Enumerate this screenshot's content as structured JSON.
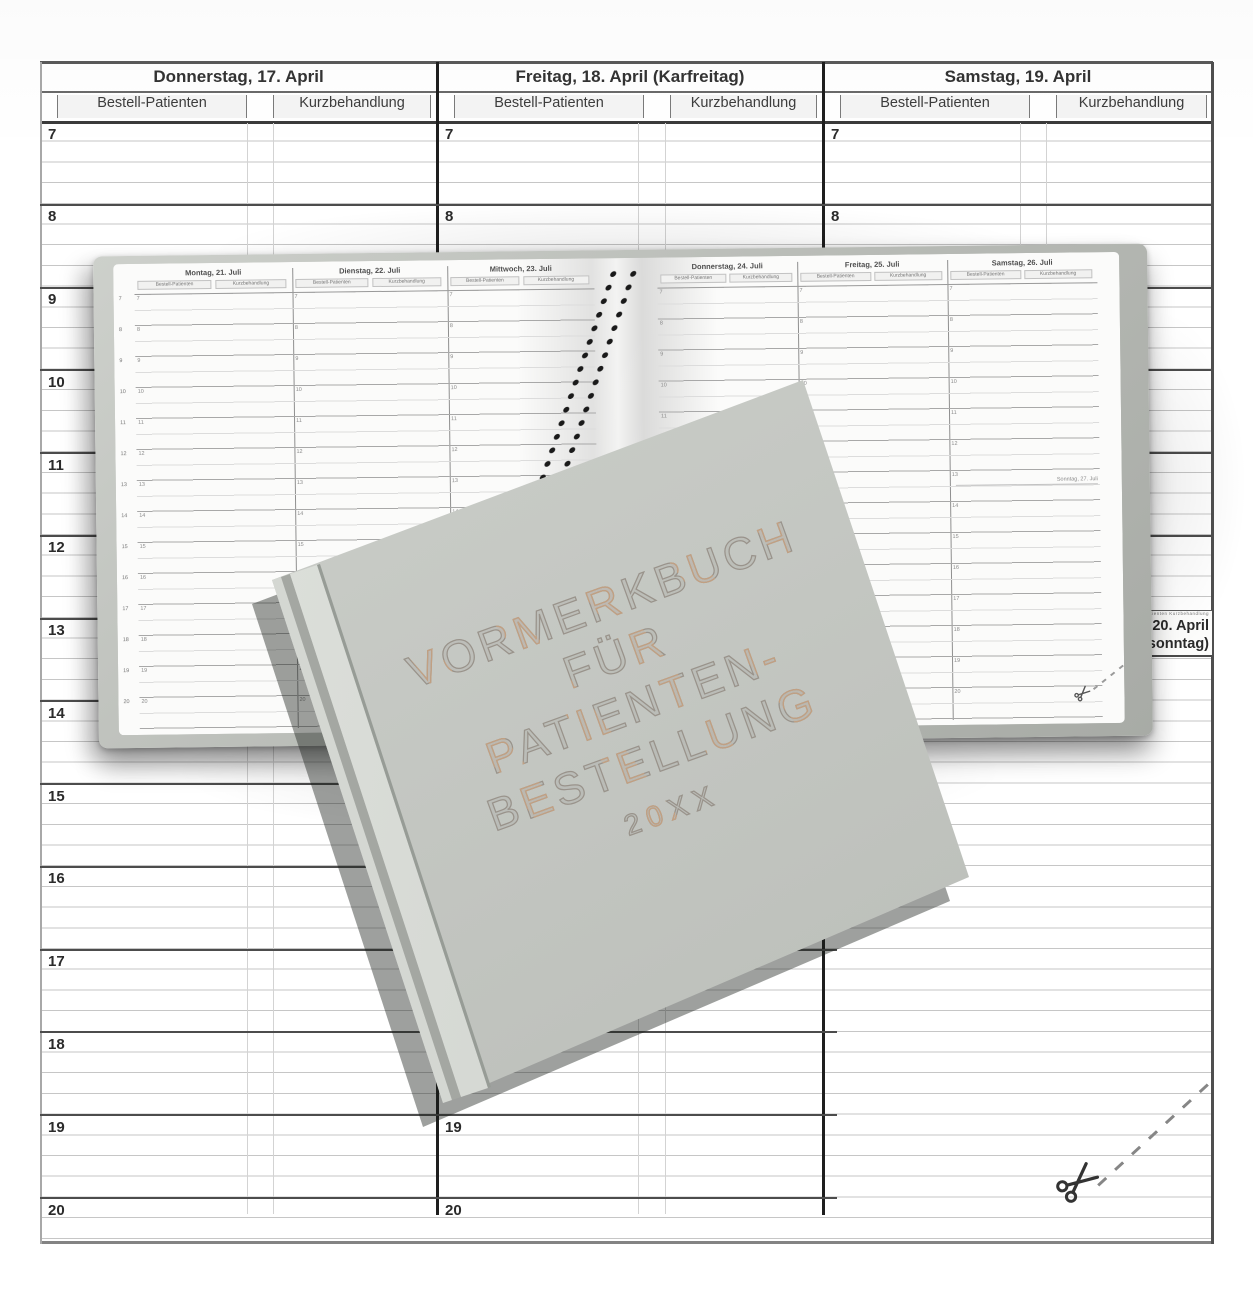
{
  "calendar": {
    "days": [
      {
        "title": "Donnerstag, 17. April",
        "sub_left": "Bestell-Patienten",
        "sub_right": "Kurzbehandlung"
      },
      {
        "title": "Freitag, 18. April (Karfreitag)",
        "sub_left": "Bestell-Patienten",
        "sub_right": "Kurzbehandlung"
      },
      {
        "title": "Samstag, 19. April",
        "sub_left": "Bestell-Patienten",
        "sub_right": "Kurzbehandlung"
      }
    ],
    "hours": [
      "7",
      "8",
      "9",
      "10",
      "11",
      "12",
      "13",
      "14",
      "15",
      "16",
      "17",
      "18",
      "19",
      "20"
    ],
    "sunday_note": {
      "mini_header": "Bestell-Patienten  Kurzbehandlung",
      "line1": "Sonntag, 20. April",
      "line2": "(Ostersonntag)"
    }
  },
  "open_book": {
    "left_page_days": [
      "Montag, 21. Juli",
      "Dienstag, 22. Juli",
      "Mittwoch, 23. Juli"
    ],
    "right_page_days": [
      "Donnerstag, 24. Juli",
      "Freitag, 25. Juli",
      "Samstag, 26. Juli"
    ],
    "sub_left": "Bestell-Patienten",
    "sub_right": "Kurzbehandlung",
    "hours": [
      "7",
      "8",
      "9",
      "10",
      "11",
      "12",
      "13",
      "14",
      "15",
      "16",
      "17",
      "18",
      "19",
      "20"
    ],
    "sunday_mini_label": "Sonntag, 27. Juli"
  },
  "cover": {
    "title_lines": [
      "VORMERKBUCH",
      "FÜR",
      "PATIENTEN-",
      "BESTELLUNG"
    ],
    "year": "20XX"
  },
  "colors": {
    "cover_grey": "#c6c9c4",
    "spine_silver": "#d8dbd6",
    "foil_silver": "#99938b",
    "foil_copper": "#c2a082",
    "paper": "#fcfcfb",
    "rule_thin": "#c6c6c6",
    "hour_line": "#4c4c4c",
    "frame": "#1e1e1e"
  }
}
